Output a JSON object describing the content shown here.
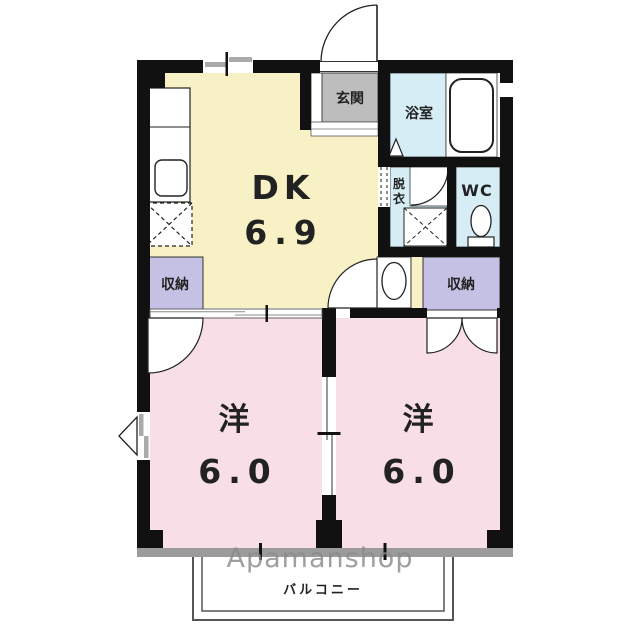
{
  "meta": {
    "width": 640,
    "height": 627,
    "background": "#ffffff"
  },
  "watermark": {
    "brand": "Apamanshop"
  },
  "rooms": {
    "dk": {
      "label": "DK",
      "area": "6.9"
    },
    "western_left": {
      "label": "洋",
      "area": "6.0"
    },
    "western_right": {
      "label": "洋",
      "area": "6.0"
    },
    "entrance": {
      "label": "玄関"
    },
    "bathroom": {
      "label": "浴室"
    },
    "dressing": {
      "label_line1": "脱",
      "label_line2": "衣"
    },
    "toilet": {
      "label": "WC"
    },
    "storage_left": {
      "label": "収納"
    },
    "storage_right": {
      "label": "収納"
    },
    "balcony": {
      "label": "バルコニー"
    }
  },
  "palette": {
    "wall": "#111111",
    "dk_fill": "#F8F1C6",
    "room_fill": "#F8DEE7",
    "storage_fill": "#C5C1E5",
    "wet_area_fill": "#D6EDF6",
    "entrance_fill": "#BDBDBD",
    "window_band": "#9B9B9B",
    "balcony_line": "#555555",
    "watermark_gray": "#8A8A8A"
  }
}
